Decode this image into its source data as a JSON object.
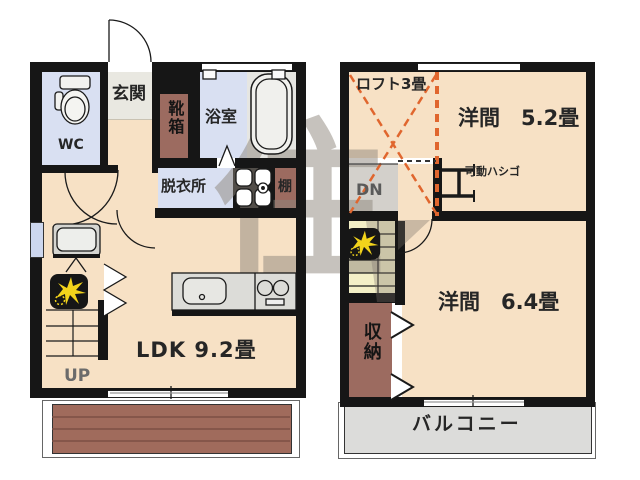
{
  "floor1": {
    "wc": "WC",
    "entrance": "玄関",
    "shoe_box": "靴箱",
    "bathroom": "浴室",
    "dressing_room": "脱衣所",
    "shelf": "棚",
    "living": "LDK 9.2畳",
    "stairs_up": "UP"
  },
  "floor2": {
    "loft": "ロフト3畳",
    "room_5_2": "洋間　5.2畳",
    "ladder": "可動ハシゴ",
    "stairs_down": "DN",
    "closet": "収納",
    "room_6_4": "洋間　6.4畳",
    "balcony": "バルコニー"
  },
  "watermark": "住",
  "colors": {
    "wall": "#161616",
    "floor": "#f7e1c5",
    "wet_floor": "#d9e0f2",
    "entrance_tile": "#e9e8e1",
    "cabinet_brown": "#9c6b60",
    "terrace_brown": "#a06b5c",
    "balcony_gray": "#dcdcda",
    "stairs_yellow": "#f3efc6",
    "landing_gray": "#d3d0cb",
    "loft_dash_orange": "#e0662e",
    "icon_star_yellow": "#f2d31b",
    "watermark_gray": "#8d867c"
  },
  "icons": {
    "stairs_marker": "sunburst-icon",
    "ladder": "ladder-icon",
    "toilet": "toilet-icon",
    "bathtub": "bathtub-icon",
    "kitchen_sink": "kitchen-sink-icon",
    "stove": "stove-icon",
    "washbasin": "washbasin-icon",
    "washer_pan": "washer-pan-icon"
  }
}
